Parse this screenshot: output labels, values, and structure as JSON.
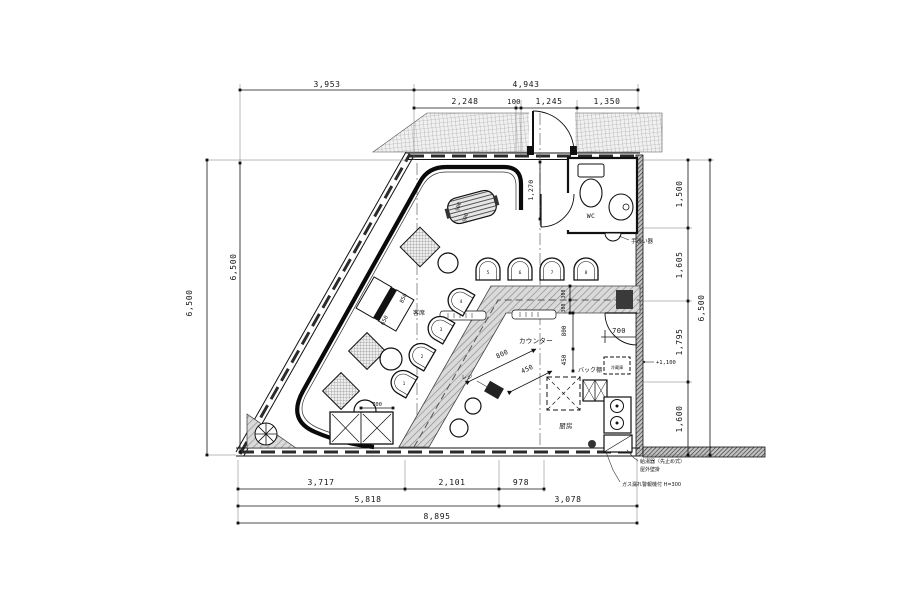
{
  "drawing": {
    "dims": {
      "top_row1": [
        "3,953",
        "4,943"
      ],
      "top_row2": [
        "2,248",
        "100",
        "1,245",
        "1,350"
      ],
      "left": [
        "6,500",
        "6,500"
      ],
      "right": [
        "1,500",
        "1,605",
        "1,795",
        "1,600"
      ],
      "right_total": "6,500",
      "bottom_row1": [
        "3,717",
        "2,101",
        "978"
      ],
      "bottom_row2": [
        "5,818",
        "3,078"
      ],
      "bottom_total": "8,895",
      "interior": {
        "entry_depth": "1,270",
        "counter_width_a": "300",
        "counter_width_b": "300",
        "counter_len_a": "800",
        "counter_len_b": "450",
        "aisle_a": "800",
        "aisle_b": "450",
        "shelf_width": "700",
        "unit_width": "700",
        "table_len_a": "650",
        "table_len_b": "850",
        "table_500a": "500",
        "table_500b": "500"
      }
    },
    "labels": {
      "wc": "WC",
      "hand_wash": "手洗い器",
      "counter": "カウンター",
      "back_shelf": "バック棚",
      "kitchen": "厨房",
      "seating": "客席",
      "register": "レジ",
      "fridge": "冷蔵庫",
      "level_note": "+1,100",
      "note_heater_line1": "給湯器（先止め式）",
      "note_heater_line2": "屋外壁掛",
      "note_gas": "ガス漏れ警報機付 H=300"
    },
    "seats": [
      "1",
      "2",
      "3",
      "4",
      "5",
      "6",
      "7",
      "8"
    ],
    "colors": {
      "line": "#1a1a1a",
      "wall_fill": "#c9c9c9",
      "counter_fill": "#dcdcdc",
      "tile_fill": "#f2f2f2",
      "paper": "#ffffff"
    }
  }
}
